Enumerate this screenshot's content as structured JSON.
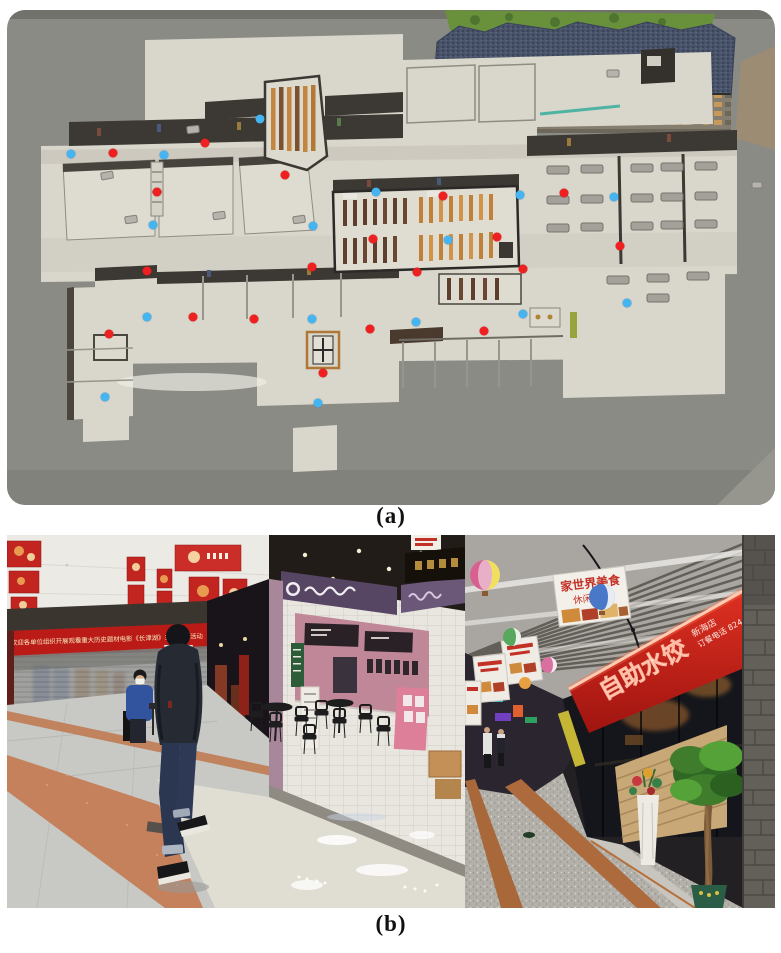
{
  "figure": {
    "caption_a": "(a)",
    "caption_b": "(b)"
  },
  "map": {
    "marker_colors": {
      "red": "#ee2020",
      "blue": "#45b4f0"
    },
    "red_dots": [
      [
        106,
        143
      ],
      [
        198,
        133
      ],
      [
        150,
        182
      ],
      [
        278,
        165
      ],
      [
        366,
        229
      ],
      [
        436,
        186
      ],
      [
        557,
        183
      ],
      [
        490,
        227
      ],
      [
        613,
        236
      ],
      [
        140,
        261
      ],
      [
        305,
        257
      ],
      [
        186,
        307
      ],
      [
        247,
        309
      ],
      [
        102,
        324
      ],
      [
        363,
        319
      ],
      [
        316,
        363
      ],
      [
        410,
        262
      ],
      [
        516,
        259
      ],
      [
        477,
        321
      ]
    ],
    "blue_dots": [
      [
        64,
        144
      ],
      [
        157,
        145
      ],
      [
        253,
        109
      ],
      [
        146,
        215
      ],
      [
        306,
        216
      ],
      [
        369,
        182
      ],
      [
        513,
        185
      ],
      [
        607,
        187
      ],
      [
        441,
        230
      ],
      [
        140,
        307
      ],
      [
        305,
        309
      ],
      [
        98,
        387
      ],
      [
        311,
        393
      ],
      [
        620,
        293
      ],
      [
        409,
        312
      ],
      [
        516,
        304
      ]
    ]
  },
  "photos": {
    "left": {
      "banner_text": "欢迎各单位组织开展观看重大历史题材电影《长津湖》主题党日活动"
    },
    "right": {
      "hanging_sign_top": "家世界美食",
      "hanging_sign_bottom": "休闲广场",
      "red_sign_main": "自助水饺",
      "red_sign_branch": "新海店",
      "red_sign_phone": "订餐电话 8244499992"
    }
  }
}
